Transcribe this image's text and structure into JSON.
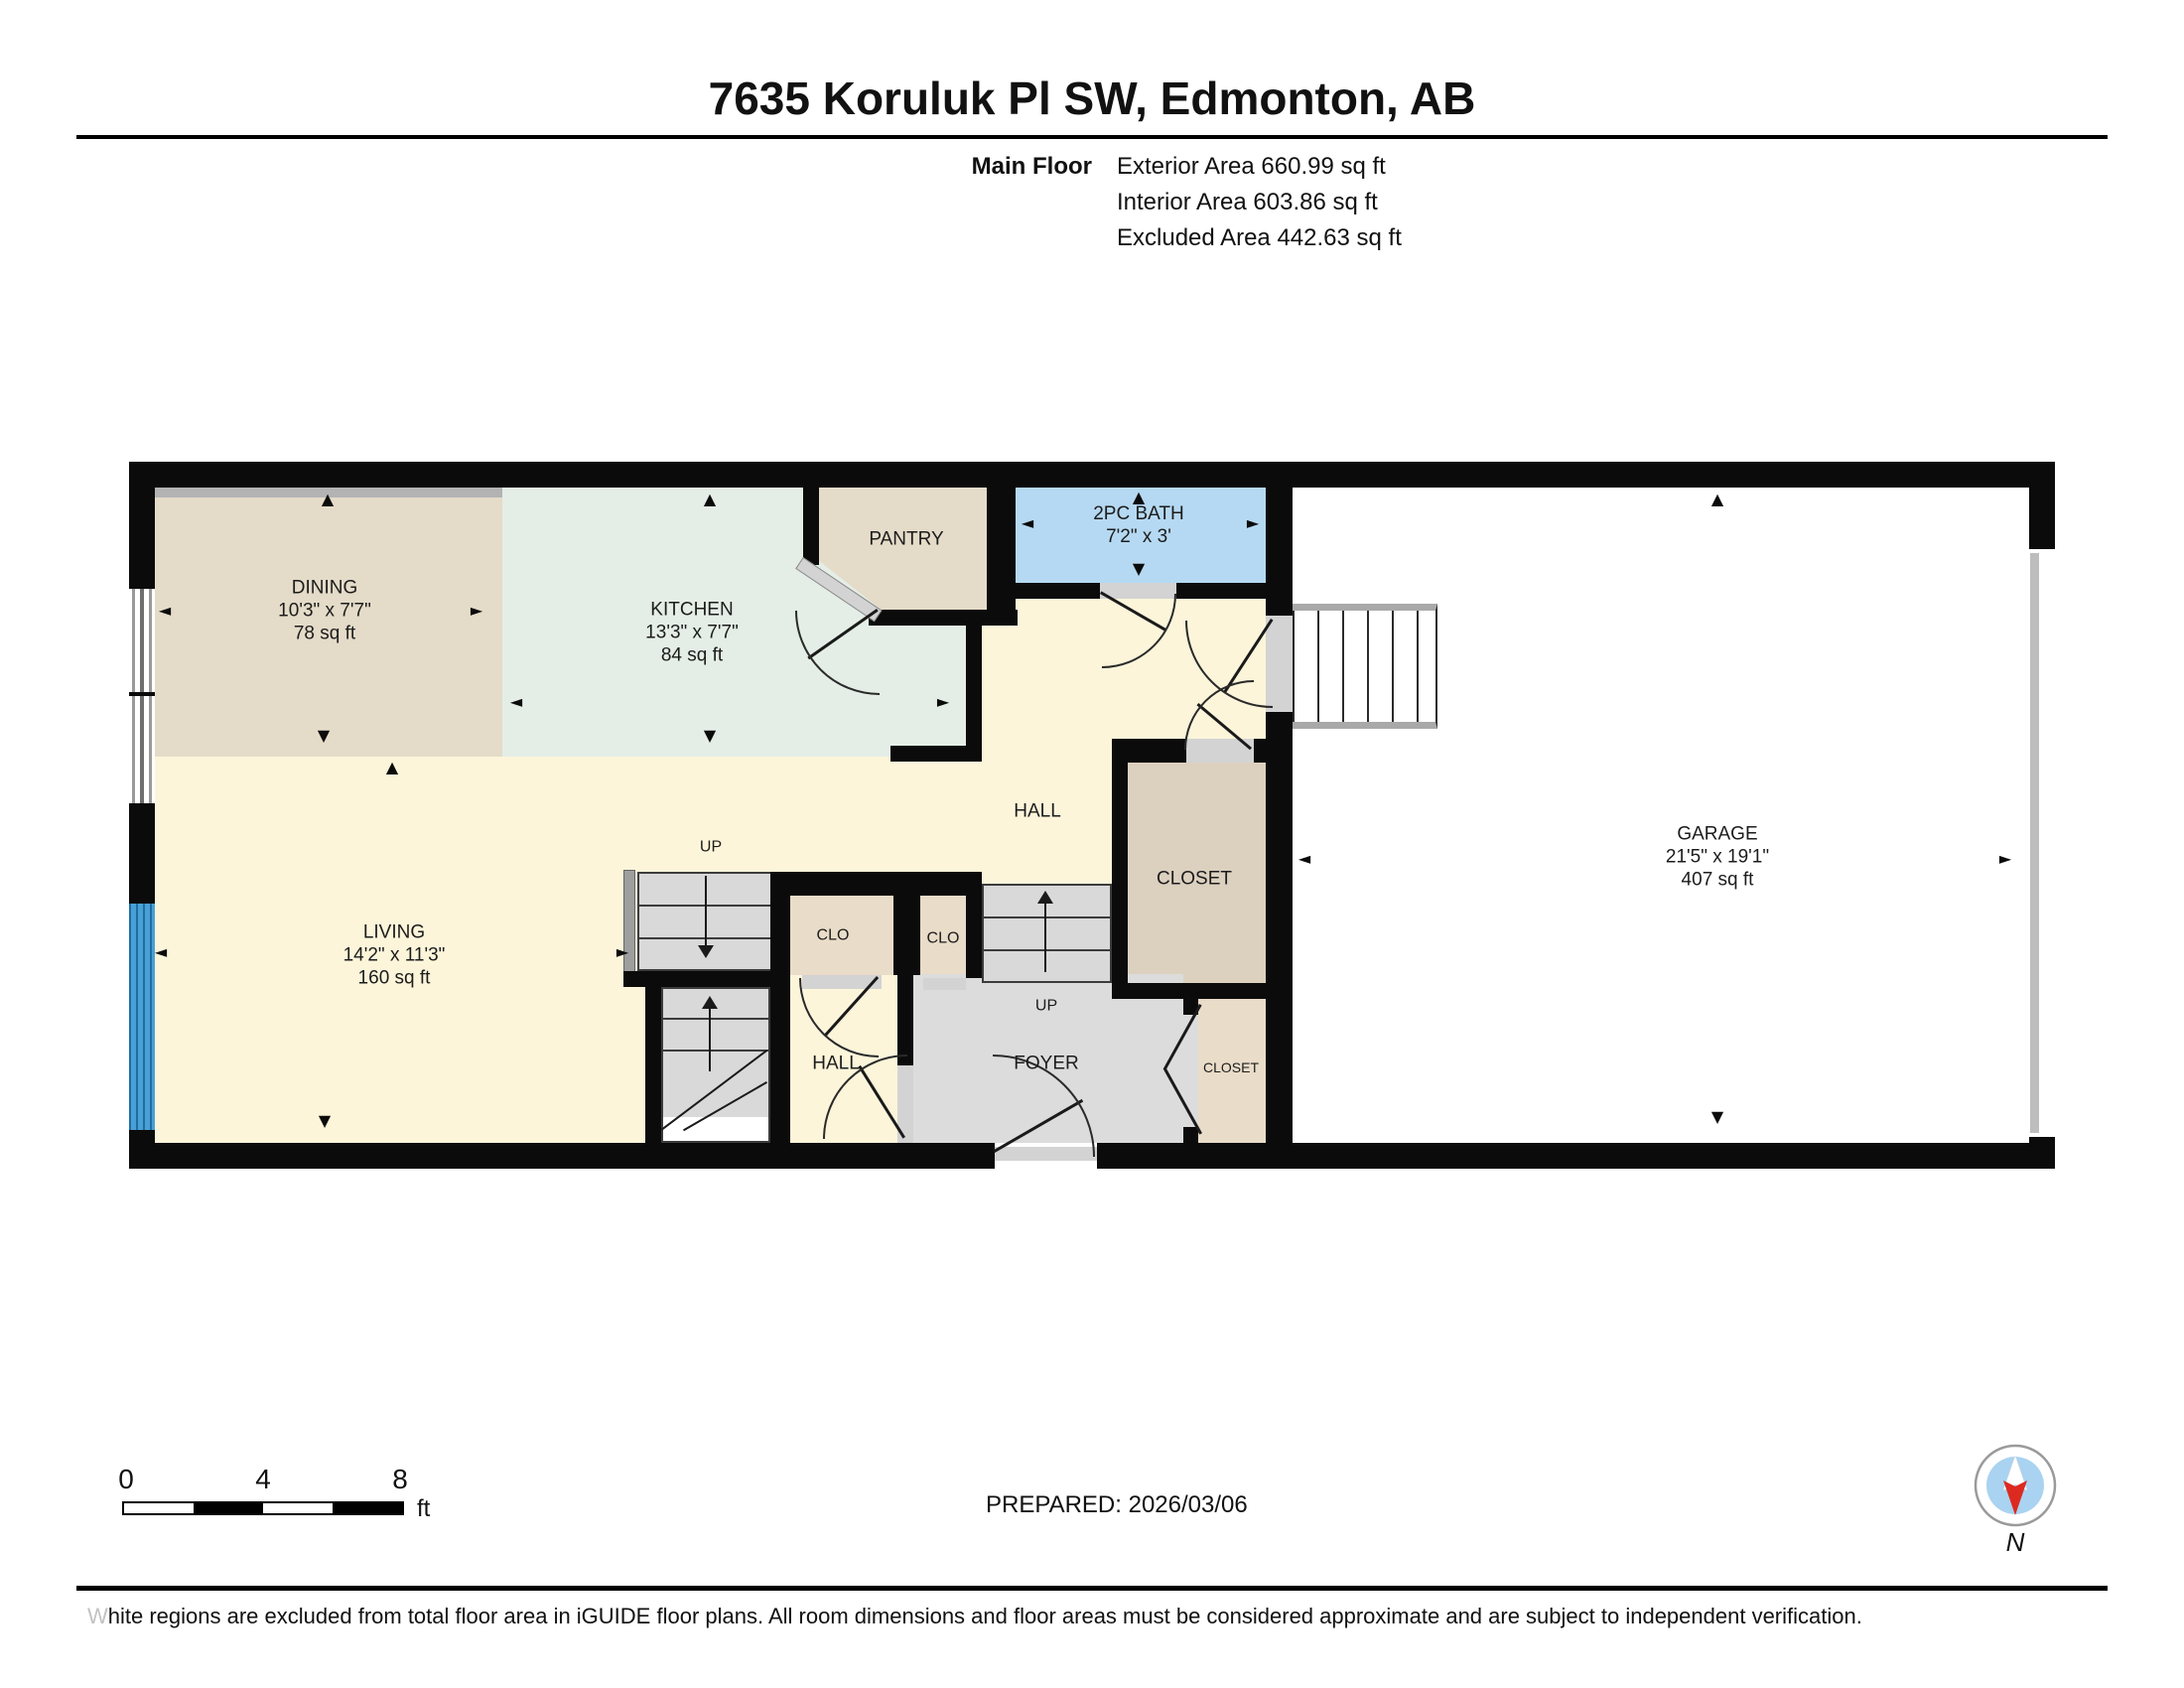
{
  "header": {
    "title": "7635 Koruluk Pl SW, Edmonton, AB",
    "floor_label": "Main Floor",
    "areas": [
      "Exterior Area 660.99 sq ft",
      "Interior Area 603.86 sq ft",
      "Excluded Area 442.63 sq ft"
    ]
  },
  "rooms": {
    "dining": {
      "name": "DINING",
      "dims": "10'3\" x 7'7\"",
      "area": "78 sq ft"
    },
    "kitchen": {
      "name": "KITCHEN",
      "dims": "13'3\" x 7'7\"",
      "area": "84 sq ft"
    },
    "pantry": {
      "name": "PANTRY"
    },
    "bath": {
      "name": "2PC BATH",
      "dims": "7'2\" x 3'"
    },
    "hall_upper": {
      "name": "HALL"
    },
    "closet_upper": {
      "name": "CLOSET"
    },
    "garage": {
      "name": "GARAGE",
      "dims": "21'5\" x 19'1\"",
      "area": "407 sq ft"
    },
    "living": {
      "name": "LIVING",
      "dims": "14'2\" x 11'3\"",
      "area": "160 sq ft"
    },
    "clo1": {
      "name": "CLO"
    },
    "clo2": {
      "name": "CLO"
    },
    "hall_lower": {
      "name": "HALL"
    },
    "foyer": {
      "name": "FOYER"
    },
    "closet_lower": {
      "name": "CLOSET"
    },
    "stairs_up_main": {
      "name": "UP"
    },
    "stairs_up_foyer": {
      "name": "UP"
    }
  },
  "icons": {
    "arrow_up": "▲",
    "arrow_down": "▼",
    "arrow_left": "◄",
    "arrow_right": "►",
    "compass_n": "N"
  },
  "scale_bar": {
    "ticks": [
      "0",
      "4",
      "8"
    ],
    "unit": "ft"
  },
  "footer": {
    "prepared": "PREPARED: 2026/03/06",
    "disclaimer_lead": "W",
    "disclaimer": "hite regions are excluded from total floor area in iGUIDE floor plans. All room dimensions and floor areas must be considered approximate and are subject to independent verification."
  },
  "colors": {
    "wall": "#0b0b0b",
    "dining": "#e4dbc8",
    "kitchen": "#e4eee6",
    "cream": "#fcf5da",
    "bath": "#b5d9f2",
    "closet": "#dcd0bf",
    "clo": "#e9dcc8",
    "foyer": "#dcdcdc",
    "stairs": "#d9d9d9",
    "window_blue": "#4aa0d4",
    "compass_red": "#dd2a20",
    "compass_blue": "#a9d3f0"
  }
}
